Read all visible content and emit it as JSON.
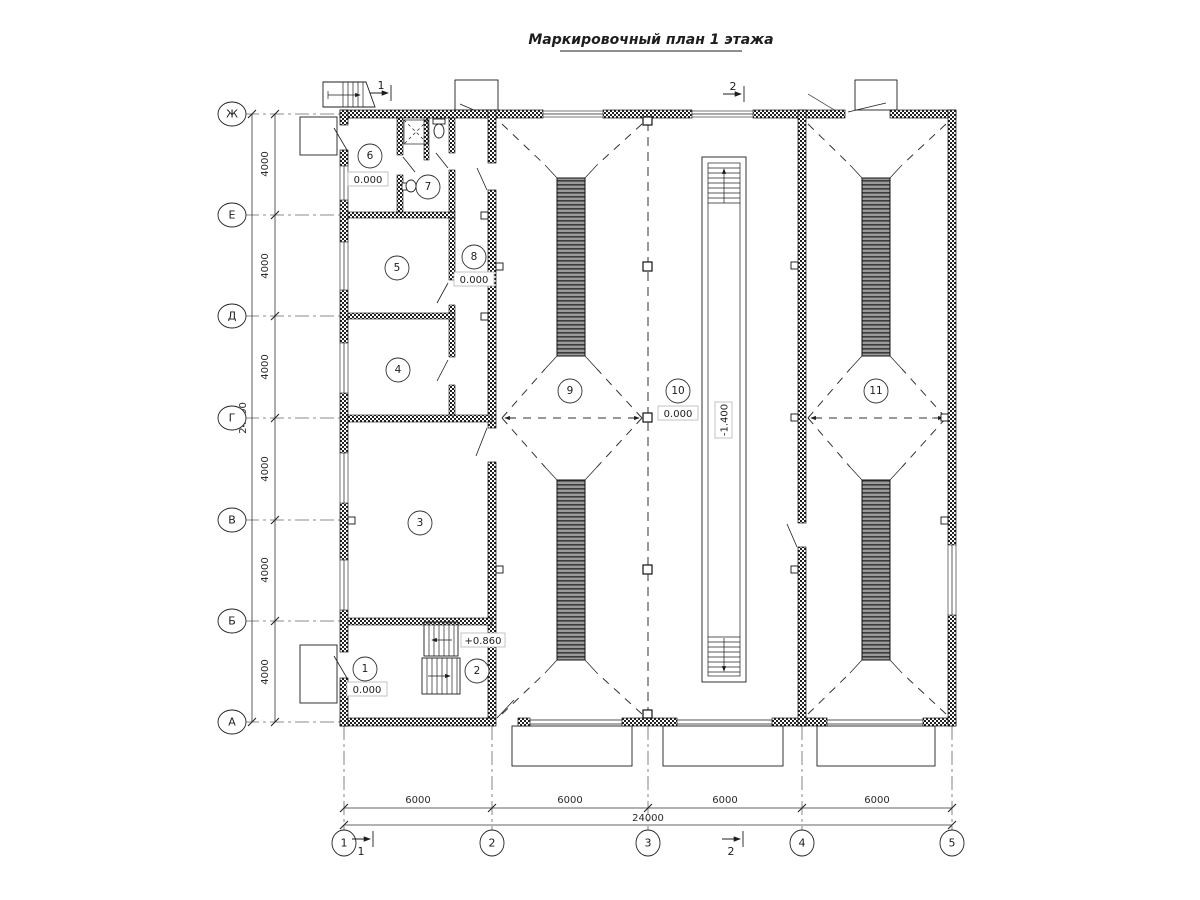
{
  "title": "Маркировочный план 1 этажа",
  "axes": {
    "rows": [
      "Ж",
      "Е",
      "Д",
      "Г",
      "В",
      "Б",
      "А"
    ],
    "cols": [
      "1",
      "2",
      "3",
      "4",
      "5"
    ]
  },
  "dims": {
    "v": [
      "4000",
      "4000",
      "4000",
      "4000",
      "4000",
      "4000"
    ],
    "v_total": "24000",
    "h": [
      "6000",
      "6000",
      "6000",
      "6000"
    ],
    "h_total": "24000"
  },
  "rooms": [
    {
      "num": "1",
      "elev": "0.000"
    },
    {
      "num": "2",
      "elev": "+0.860"
    },
    {
      "num": "3"
    },
    {
      "num": "4"
    },
    {
      "num": "5"
    },
    {
      "num": "6",
      "elev": "0.000"
    },
    {
      "num": "7"
    },
    {
      "num": "8",
      "elev": "0.000"
    },
    {
      "num": "9"
    },
    {
      "num": "10",
      "elev": "0.000"
    },
    {
      "num": "11"
    }
  ],
  "pit": {
    "elev": "-1.400"
  },
  "sections": {
    "s1": "1",
    "s2": "2"
  }
}
